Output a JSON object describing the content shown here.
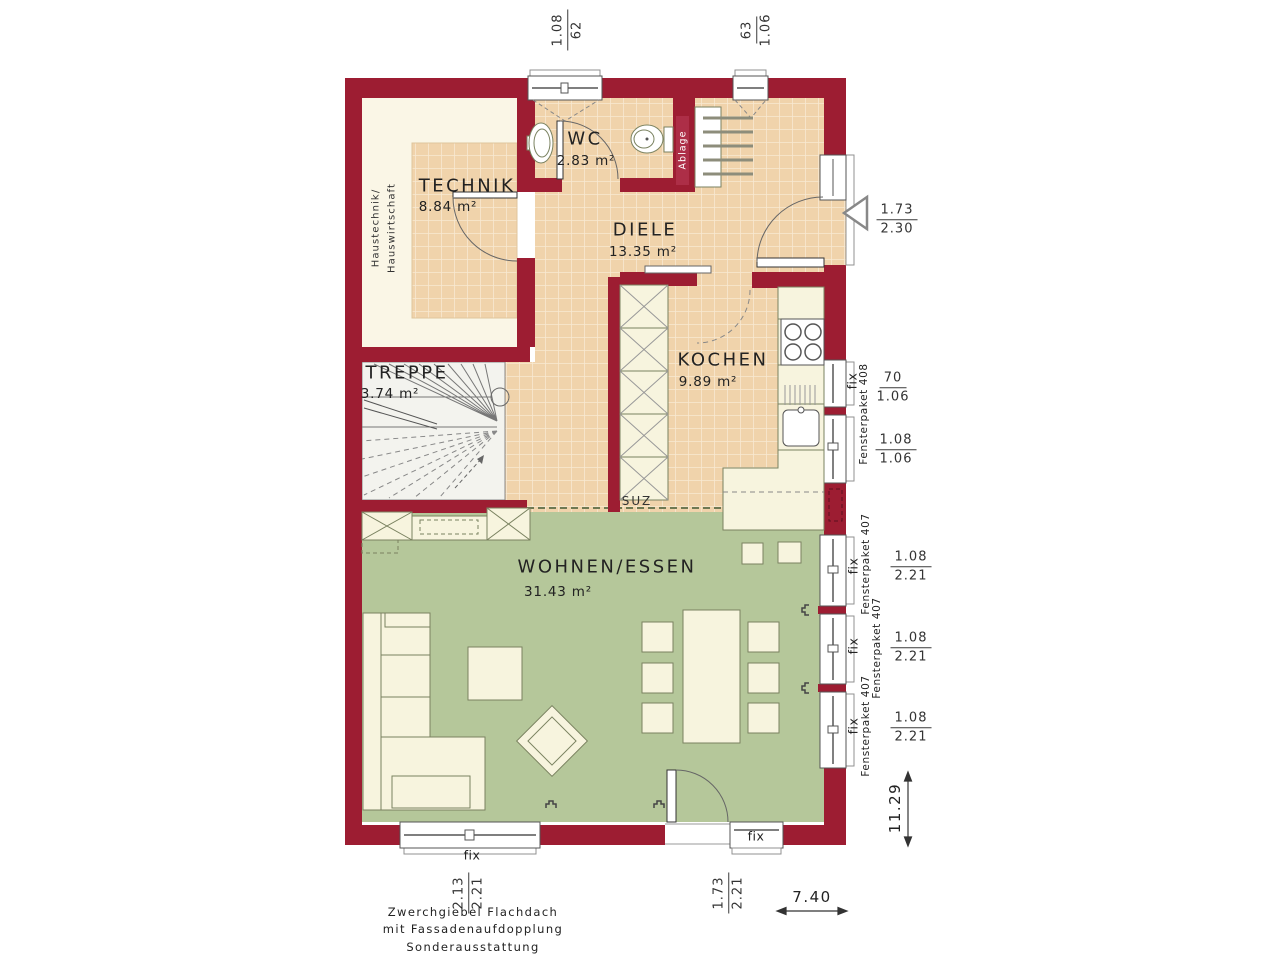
{
  "colors": {
    "wall": "#9d1d32",
    "wall_niche": "#ad2e47",
    "tile": "#f0d3ab",
    "tile_grid": "#f8e9d1",
    "green": "#b5c79a",
    "cream": "#faf6e6",
    "stairs": "#f3f3ee",
    "furniture": "#f7f4de",
    "outline": "#7a8260",
    "frame": "#555555",
    "sill": "#919191",
    "ink": "#2e2e2e",
    "dash": "#6e7852"
  },
  "rooms": {
    "technik": {
      "name": "TECHNIK",
      "area": "8.84 m²",
      "sub1": "Haustechnik/",
      "sub2": "Hauswirtschaft"
    },
    "wc": {
      "name": "WC",
      "area": "2.83 m²"
    },
    "diele": {
      "name": "DIELE",
      "area": "13.35 m²"
    },
    "kochen": {
      "name": "KOCHEN",
      "area": "9.89 m²"
    },
    "treppe": {
      "name": "TREPPE",
      "area": "3.74 m²"
    },
    "wohnen": {
      "name": "WOHNEN/ESSEN",
      "area": "31.43 m²"
    },
    "ablage": "Ablage",
    "suz": "SUZ"
  },
  "windows": {
    "fix": "fix",
    "paket408": "Fensterpaket 408",
    "paket407": "Fensterpaket 407"
  },
  "dims": {
    "top": [
      {
        "num": "1.08",
        "den": "62"
      },
      {
        "num": "63",
        "den": "1.06"
      }
    ],
    "door": {
      "num": "1.73",
      "den": "2.30"
    },
    "kitchen": [
      {
        "num": "70",
        "den": "1.06"
      },
      {
        "num": "1.08",
        "den": "1.06"
      }
    ],
    "living": [
      {
        "num": "1.08",
        "den": "2.21"
      },
      {
        "num": "1.08",
        "den": "2.21"
      },
      {
        "num": "1.08",
        "den": "2.21"
      }
    ],
    "bottom": [
      {
        "num": "2.13",
        "den": "2.21"
      },
      {
        "num": "1.73",
        "den": "2.21"
      }
    ],
    "overall_depth": "11.29",
    "overall_width": "7.40"
  },
  "notes": {
    "line1": "Zwerchgiebel Flachdach",
    "line2": "mit Fassadenaufdopplung",
    "line3": "Sonderausstattung"
  }
}
